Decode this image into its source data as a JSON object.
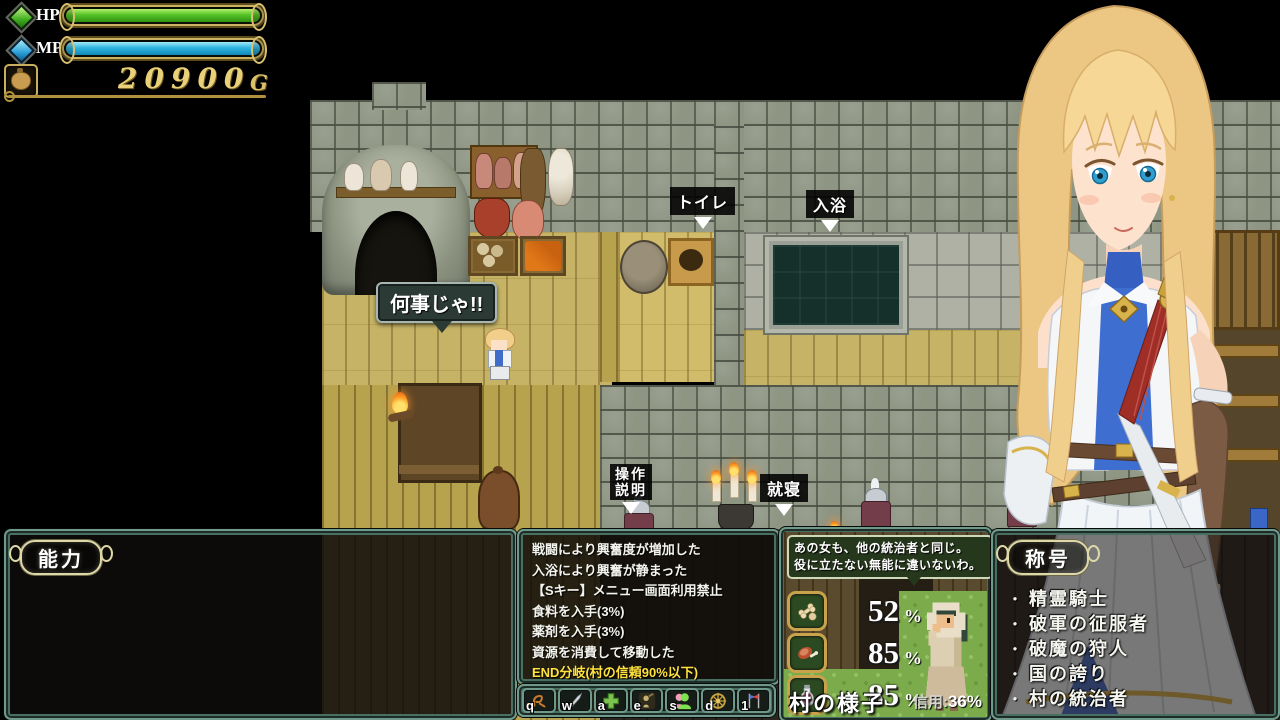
{
  "hud": {
    "hp_label": "HP",
    "mp_label": "MP",
    "hp_percent": 100,
    "mp_percent": 100,
    "gold_amount": "20900",
    "gold_unit": "G"
  },
  "map": {
    "speech_bubble": "何事じゃ!!",
    "labels": {
      "toilet": "トイレ",
      "bath": "入浴",
      "controls_line1": "操作",
      "controls_line2": "説明",
      "sleep": "就寝"
    }
  },
  "panels": {
    "ability": {
      "title": "能力"
    },
    "log": {
      "lines": [
        "戦闘により興奮度が増加した",
        "入浴により興奮が静まった",
        "【Sキー】メニュー画面利用禁止",
        "食料を入手(3%)",
        "薬剤を入手(3%)",
        "資源を消費して移動した",
        "END分岐(村の信頼90%以下)"
      ],
      "highlight_color": "#ffe23e"
    },
    "hotbar": {
      "keys": [
        {
          "key": "q",
          "icon": "rune-icon"
        },
        {
          "key": "w",
          "icon": "sword-icon"
        },
        {
          "key": "a",
          "icon": "heal-cross-icon"
        },
        {
          "key": "e",
          "icon": "labor-icon"
        },
        {
          "key": "s",
          "icon": "party-icon"
        },
        {
          "key": "d",
          "icon": "compass-icon"
        },
        {
          "key": "1",
          "icon": "flags-icon"
        }
      ]
    },
    "village": {
      "bubble_line1": "あの女も、他の統治者と同じ。",
      "bubble_line2": "役に立たない無能に違いないわ。",
      "stats": [
        {
          "icon": "food-icon",
          "value": "52",
          "unit": "%"
        },
        {
          "icon": "meat-icon",
          "value": "85",
          "unit": "%"
        },
        {
          "icon": "potion-icon",
          "value": "85",
          "unit": "%"
        }
      ],
      "footer": "村の様子",
      "trust_label": "信用",
      "trust_sep": ":",
      "trust_value": "36%"
    },
    "titles": {
      "title": "称号",
      "bullet": "・",
      "items": [
        "精霊騎士",
        "破軍の征服者",
        "破魔の狩人",
        "国の誇り",
        "村の統治者"
      ]
    }
  },
  "colors": {
    "hp_bar": "#54c226",
    "mp_bar": "#2fb4e0",
    "gold_text": "#e8d178",
    "log_highlight": "#ffe23e",
    "panel_border": "#6f998a",
    "grass": "#7cab4c"
  }
}
